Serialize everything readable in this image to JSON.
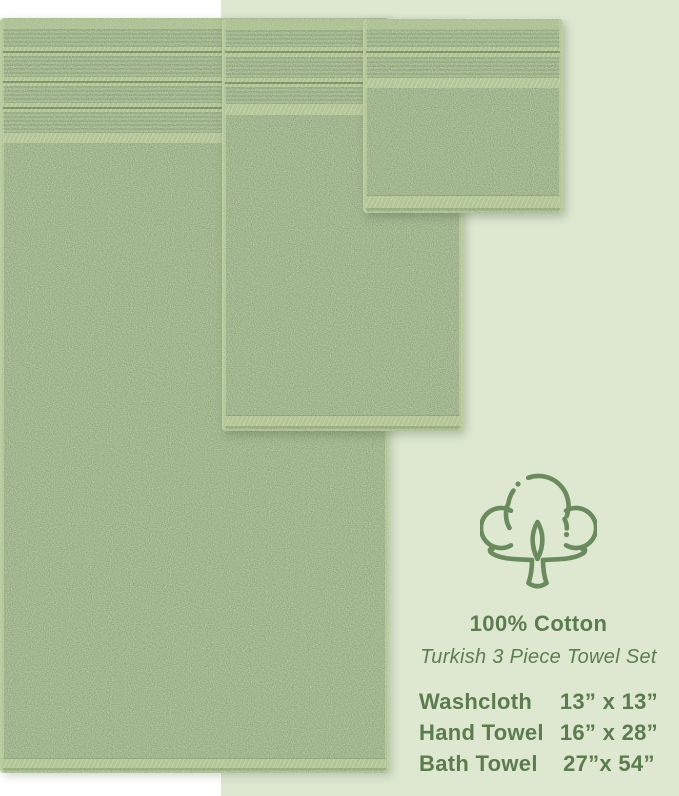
{
  "product_image": {
    "background_color": "#ffffff",
    "panel_color": "#dee8d1",
    "towel_pile_color": "#97ad80",
    "towel_trim_color": "#b7c996",
    "towels": [
      {
        "name": "Bath Towel",
        "stripe_bands": 4
      },
      {
        "name": "Hand Towel",
        "stripe_bands": 3
      },
      {
        "name": "Washcloth",
        "stripe_bands": 2
      }
    ]
  },
  "info_panel": {
    "icon": "cotton-flower-icon",
    "icon_color": "#6b8a5e",
    "text_color": "#5c7b4e",
    "heading": "100% Cotton",
    "subheading": "Turkish 3 Piece Towel Set",
    "size_list": [
      {
        "item": "Washcloth",
        "dimensions": "13” x 13”"
      },
      {
        "item": "Hand Towel",
        "dimensions": "16” x 28”"
      },
      {
        "item": "Bath Towel",
        "dimensions": "27”x 54”"
      }
    ]
  }
}
